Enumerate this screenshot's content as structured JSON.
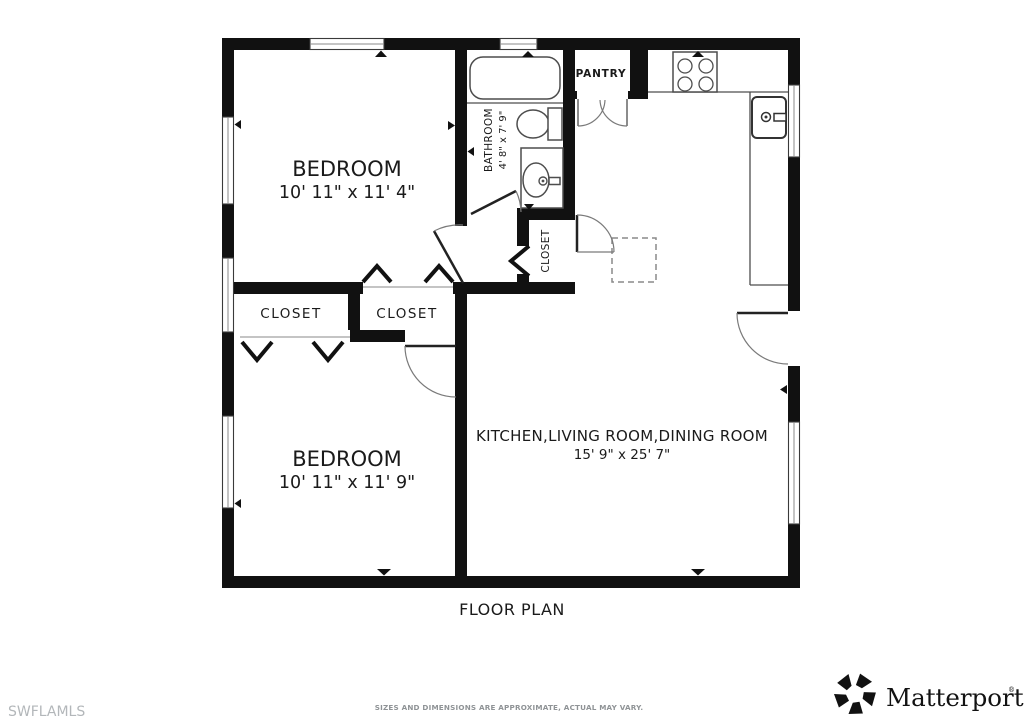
{
  "page": {
    "title": "FLOOR PLAN",
    "watermark": "SWFLAMLS",
    "disclaimer": "SIZES AND DIMENSIONS ARE APPROXIMATE, ACTUAL MAY VARY."
  },
  "brand": {
    "name": "Matterport",
    "registered": "®"
  },
  "rooms": {
    "bedroom_top": {
      "label": "BEDROOM",
      "dims": "10' 11\" x 11' 4\""
    },
    "bedroom_bottom": {
      "label": "BEDROOM",
      "dims": "10' 11\" x 11' 9\""
    },
    "bathroom": {
      "label": "BATHROOM",
      "dims": "4' 8\" x 7' 9\""
    },
    "pantry": {
      "label": "PANTRY"
    },
    "closet_left": {
      "label": "CLOSET"
    },
    "closet_right": {
      "label": "CLOSET"
    },
    "closet_hall": {
      "label": "CLOSET"
    },
    "main": {
      "label": "KITCHEN,LIVING ROOM,DINING ROOM",
      "dims": "15' 9\" x 25' 7\""
    }
  },
  "colors": {
    "wall": "#111111",
    "fixture_line": "#4d4d4d",
    "door_arc": "#7a7a7a",
    "label_text": "#1a1a1a",
    "muted_text": "#8f9396",
    "watermark_text": "#b3b7ba",
    "background": "#ffffff"
  }
}
